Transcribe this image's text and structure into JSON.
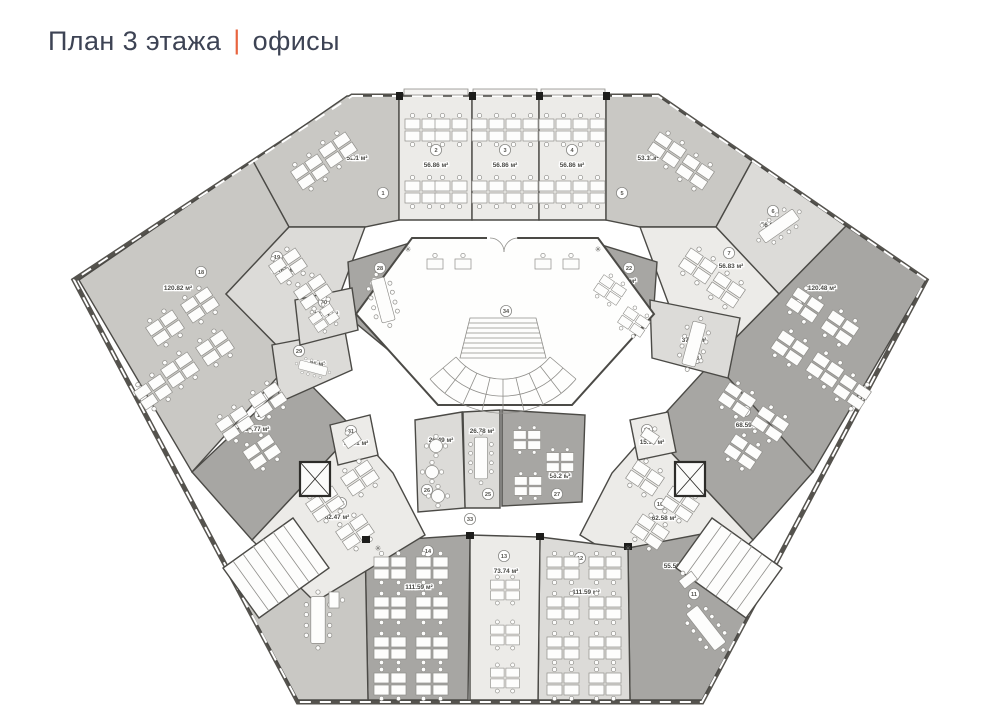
{
  "title": {
    "left": "План 3 этажа",
    "divider": "|",
    "right": "офисы"
  },
  "accent": "#e8643f",
  "units": "м²",
  "palette": {
    "light": "#ecebe8",
    "midlight": "#dcdbd8",
    "mid": "#c9c8c4",
    "dark": "#a7a6a3",
    "wall": "#55534e",
    "corridor": "#ffffff"
  },
  "rooms": {
    "r1": {
      "number": "1",
      "area": "53.1 м²"
    },
    "r2": {
      "number": "2",
      "area": "56.86 м²"
    },
    "r3": {
      "number": "3",
      "area": "56.86 м²"
    },
    "r4": {
      "number": "4",
      "area": "56.86 м²"
    },
    "r5": {
      "number": "5",
      "area": "53.1 м²"
    },
    "r6": {
      "number": "6",
      "area": "56.83 м²"
    },
    "r7": {
      "number": "7",
      "area": "56.83 м²"
    },
    "r8": {
      "number": "8",
      "area": "120.48 м²"
    },
    "r9": {
      "number": "9",
      "area": "68.59 м²"
    },
    "r10": {
      "number": "10",
      "area": "62.58 м²"
    },
    "r11": {
      "number": "11",
      "area": "55.59 м²"
    },
    "r12": {
      "number": "12",
      "area": "111.59 м²"
    },
    "r13": {
      "number": "13",
      "area": "73.74 м²"
    },
    "r14": {
      "number": "14",
      "area": "111.59 м²"
    },
    "r15": {
      "number": "15",
      "area": "79.11 м²"
    },
    "r16": {
      "number": "16",
      "area": "62.47 м²"
    },
    "r17": {
      "number": "17",
      "area": "66.77 м²"
    },
    "r18": {
      "number": "18",
      "area": "120.82 м²"
    },
    "r19": {
      "number": "19",
      "area": "56.67 м²"
    },
    "r20": {
      "number": "20",
      "area": "21.21 м²"
    },
    "r21": {
      "number": "21",
      "area": "21.02 м²"
    },
    "r22": {
      "number": "22",
      "area": "45.39 м²"
    },
    "r23": {
      "number": "23",
      "area": "37.95 м²"
    },
    "r24": {
      "number": "24",
      "area": "15.92 м²"
    },
    "r25": {
      "number": "25",
      "area": "26.78 м²"
    },
    "r26": {
      "number": "26",
      "area": "26.49 м²"
    },
    "r27": {
      "number": "27",
      "area": "56.2 м²"
    },
    "r28": {
      "number": "28",
      "area": "41.08 м²"
    },
    "r29": {
      "number": "29",
      "area": "17.71 м²"
    },
    "r30": {
      "number": "30",
      "area": "19.44 м²"
    },
    "r31": {
      "number": "31",
      "area": "15.91 м²"
    }
  },
  "markers": {
    "m33": {
      "number": "33"
    },
    "m34": {
      "number": "34"
    }
  }
}
